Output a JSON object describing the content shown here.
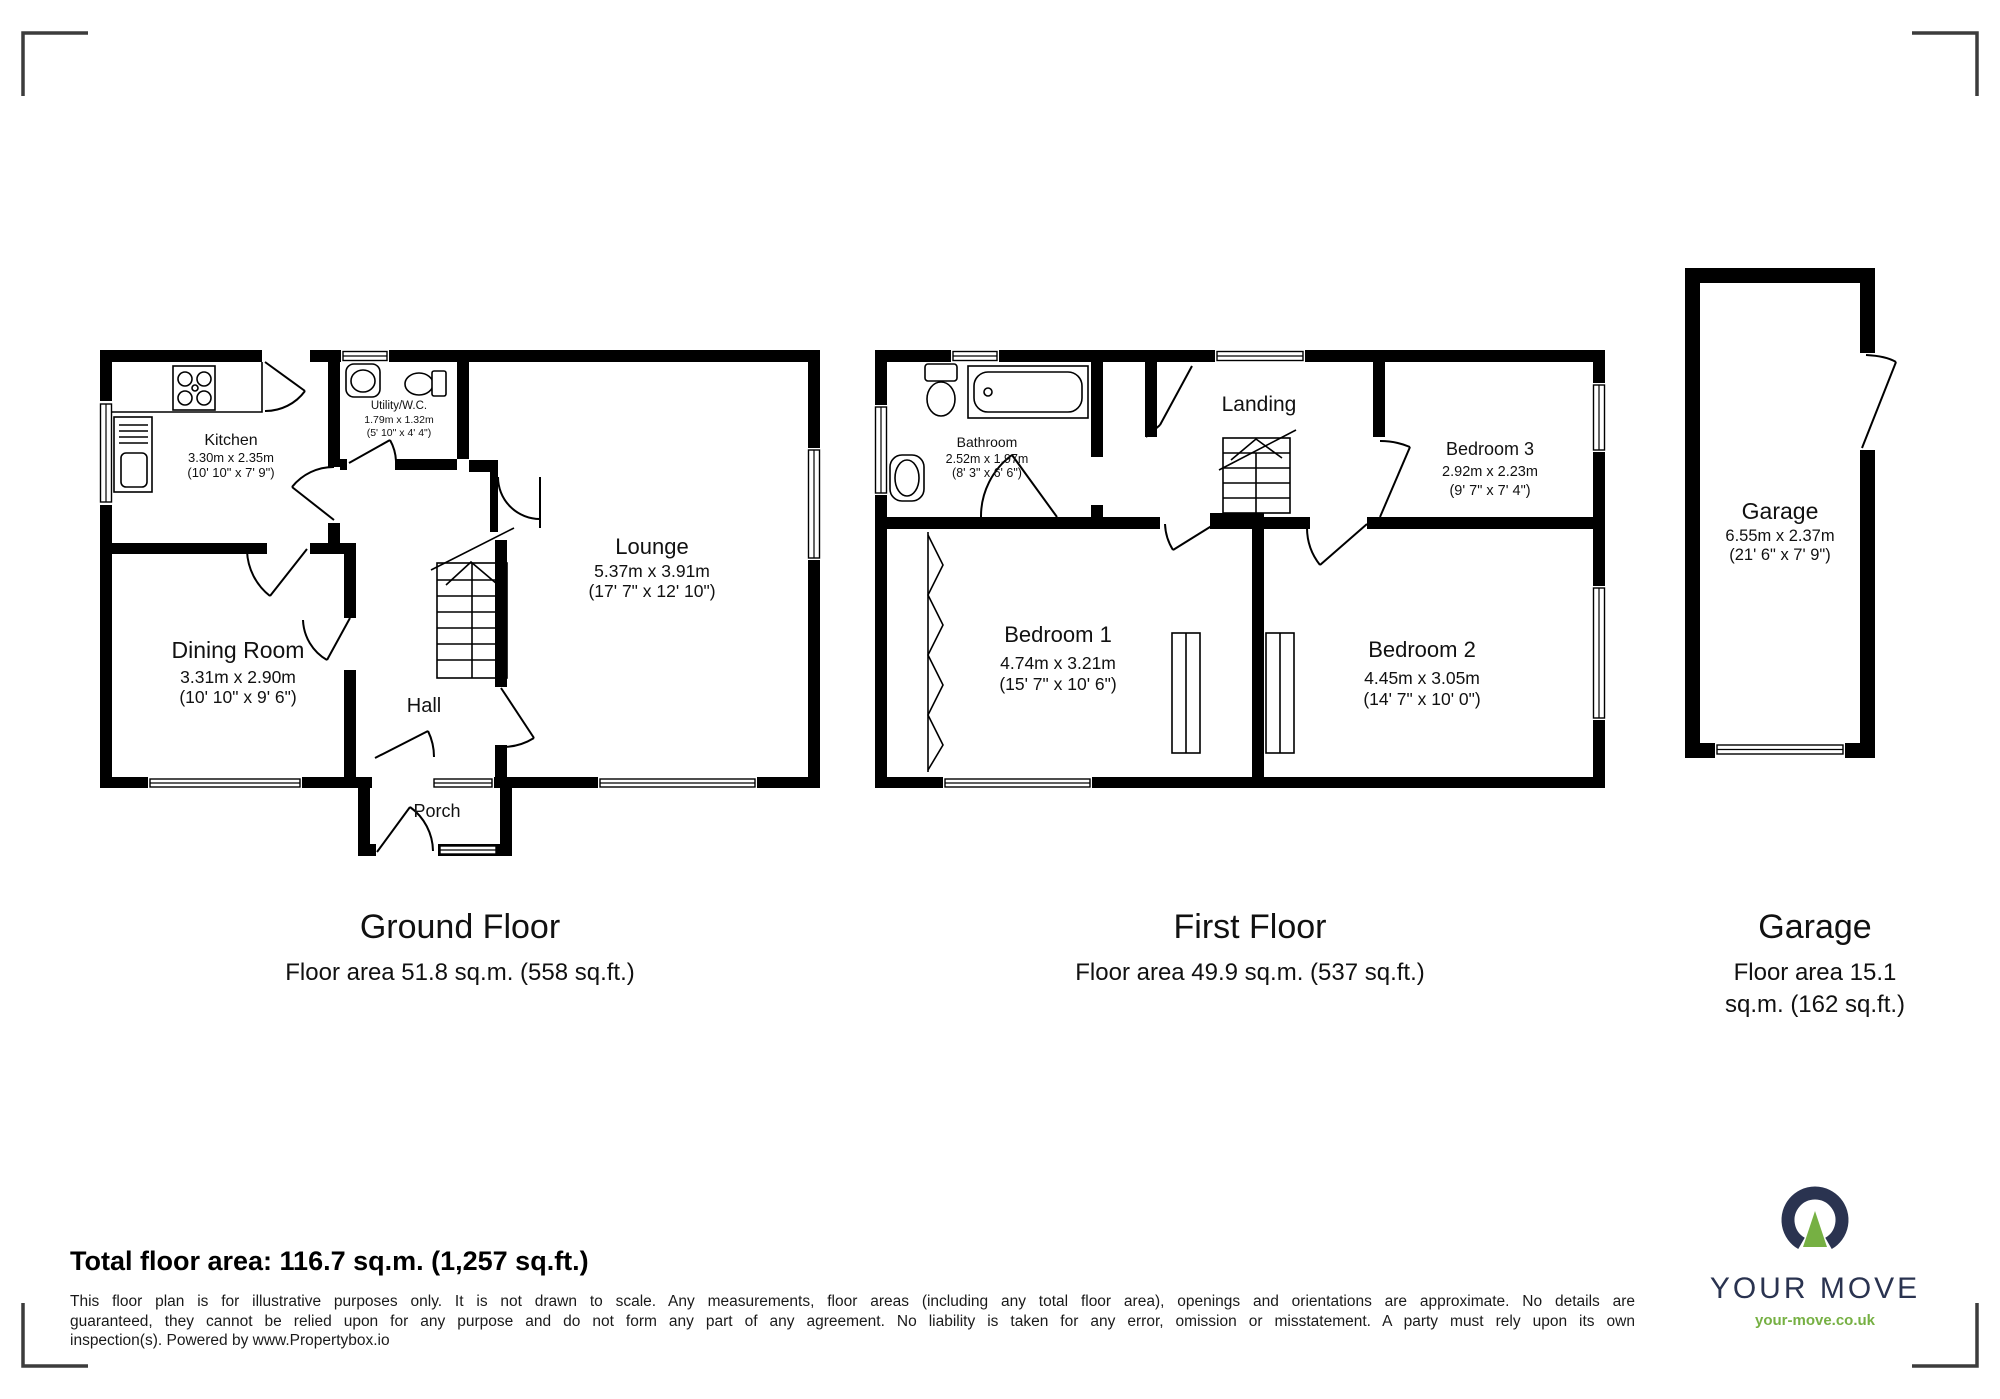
{
  "ground_floor": {
    "title": "Ground Floor",
    "area_label": "Floor area 51.8 sq.m. (558 sq.ft.)",
    "rooms": {
      "kitchen": {
        "name": "Kitchen",
        "metric": "3.30m x 2.35m",
        "imperial": "(10' 10\" x 7' 9\")"
      },
      "utility": {
        "name": "Utility/W.C.",
        "metric": "1.79m x 1.32m",
        "imperial": "(5' 10\" x 4' 4\")"
      },
      "lounge": {
        "name": "Lounge",
        "metric": "5.37m x 3.91m",
        "imperial": "(17' 7\" x 12' 10\")"
      },
      "dining": {
        "name": "Dining Room",
        "metric": "3.31m x 2.90m",
        "imperial": "(10' 10\" x 9' 6\")"
      },
      "hall": {
        "name": "Hall"
      },
      "porch": {
        "name": "Porch"
      }
    }
  },
  "first_floor": {
    "title": "First Floor",
    "area_label": "Floor area 49.9 sq.m. (537 sq.ft.)",
    "rooms": {
      "bathroom": {
        "name": "Bathroom",
        "metric": "2.52m x 1.97m",
        "imperial": "(8' 3\" x 6' 6\")"
      },
      "landing": {
        "name": "Landing"
      },
      "bedroom1": {
        "name": "Bedroom 1",
        "metric": "4.74m x 3.21m",
        "imperial": "(15' 7\" x 10' 6\")"
      },
      "bedroom2": {
        "name": "Bedroom 2",
        "metric": "4.45m x 3.05m",
        "imperial": "(14' 7\" x 10' 0\")"
      },
      "bedroom3": {
        "name": "Bedroom 3",
        "metric": "2.92m x 2.23m",
        "imperial": "(9' 7\" x 7' 4\")"
      }
    }
  },
  "garage": {
    "title": "Garage",
    "area_label_line1": "Floor area 15.1",
    "area_label_line2": "sq.m. (162 sq.ft.)",
    "room": {
      "name": "Garage",
      "metric": "6.55m x 2.37m",
      "imperial": "(21' 6\" x 7' 9\")"
    }
  },
  "footer": {
    "total_area": "Total floor area: 116.7 sq.m. (1,257 sq.ft.)",
    "disclaimer_line1": "This floor plan is for illustrative purposes only. It is not drawn to scale. Any measurements, floor areas (including any total floor area), openings and orientations are approximate. No details are",
    "disclaimer_line2": "guaranteed, they cannot be relied upon for any purpose and do not form any part of any agreement. No liability is taken for any error, omission or misstatement. A party must rely upon its own",
    "disclaimer_line3": "inspection(s). Powered by www.Propertybox.io"
  },
  "branding": {
    "name": "YOUR MOVE",
    "url": "your-move.co.uk"
  }
}
